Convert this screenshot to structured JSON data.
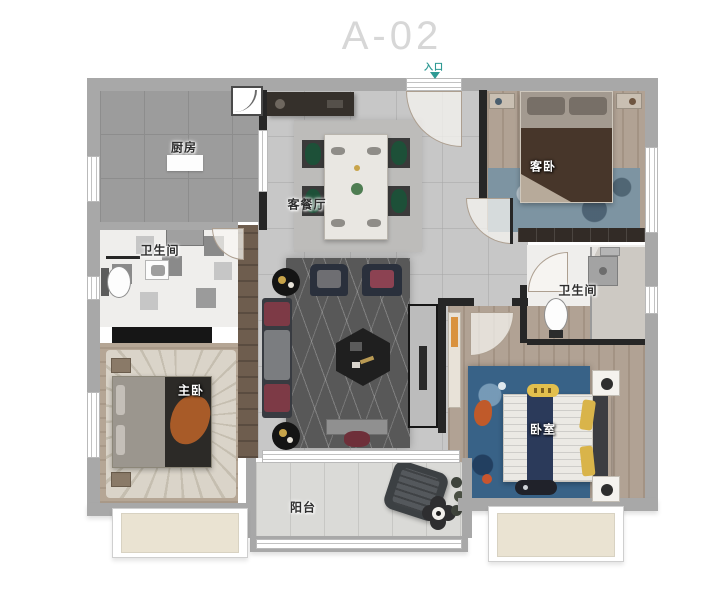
{
  "title": "A-02",
  "entrance": {
    "label": "入口"
  },
  "rooms": {
    "kitchen": {
      "label": "厨房"
    },
    "living_dining": {
      "label": "客餐厅"
    },
    "guest_bedroom": {
      "label": "客卧"
    },
    "bathroom_left": {
      "label": "卫生间"
    },
    "bathroom_right": {
      "label": "卫生间"
    },
    "master_bedroom": {
      "label": "主卧"
    },
    "kids_bedroom": {
      "label": "卧室"
    },
    "balcony": {
      "label": "阳台"
    }
  },
  "colors": {
    "title_text": "#d7d7d7",
    "entrance_marker": "#2f9a94",
    "outer_wall": "#a8a8a8",
    "inner_wall": "#262626",
    "marble_floor": "#c7c7c7",
    "kitchen_floor": "#9c9c9c",
    "wood_floor": "#b1a294",
    "living_rug": "#585858",
    "kids_rug": "#386287",
    "guest_rug": "#7d94a2",
    "dining_chair_green": "#1d5038",
    "orange_throw": "#a85b28",
    "navy_runner": "#2b3a5a",
    "yellow_pillow": "#d9b44a",
    "maroon_cushion": "#7d3a46",
    "bay_window_fill": "#eae3d2"
  }
}
